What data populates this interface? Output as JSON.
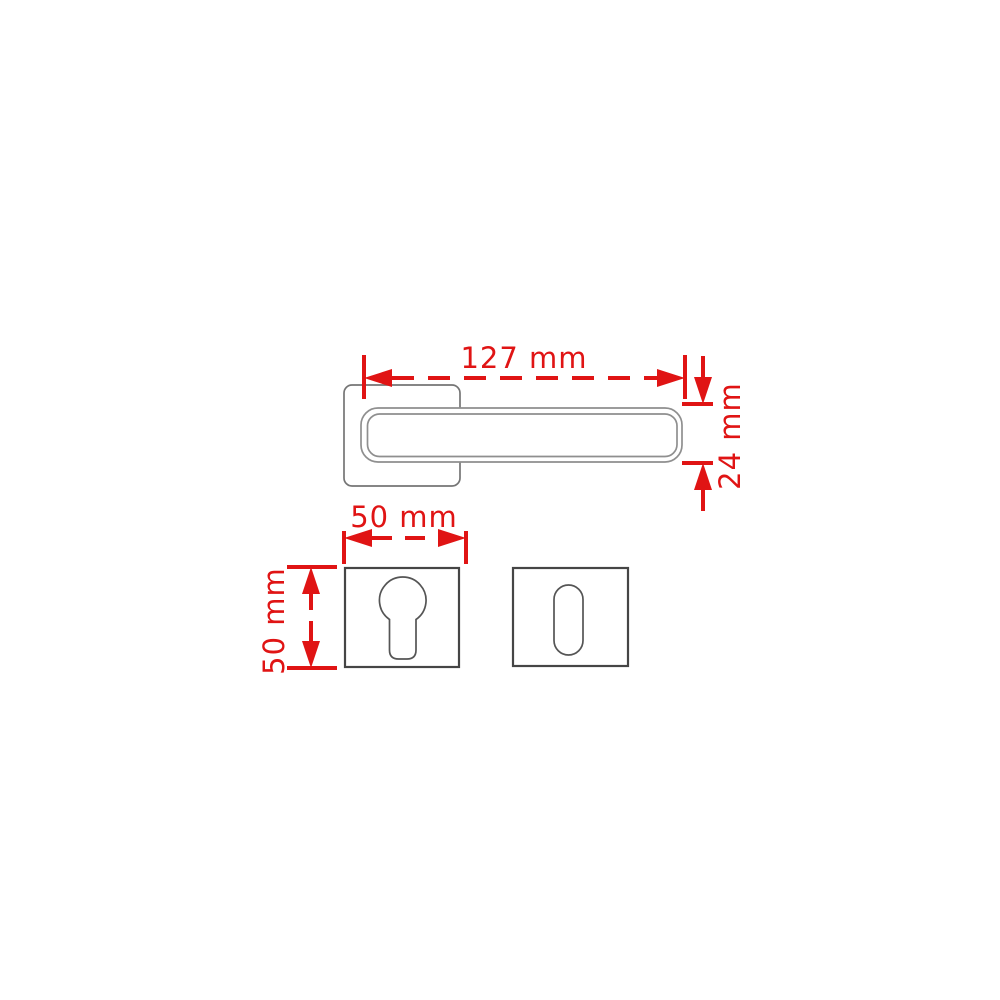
{
  "colors": {
    "background": "#ffffff",
    "dimension_red": "#e01414",
    "plate_outline": "#454545",
    "rose_outline": "#757575",
    "handle_outline": "#8f8f8f",
    "keyhole_outline": "#555555"
  },
  "dimensions": {
    "handle_length": "127 mm",
    "handle_height": "24 mm",
    "plate_width": "50 mm",
    "plate_height": "50 mm"
  }
}
